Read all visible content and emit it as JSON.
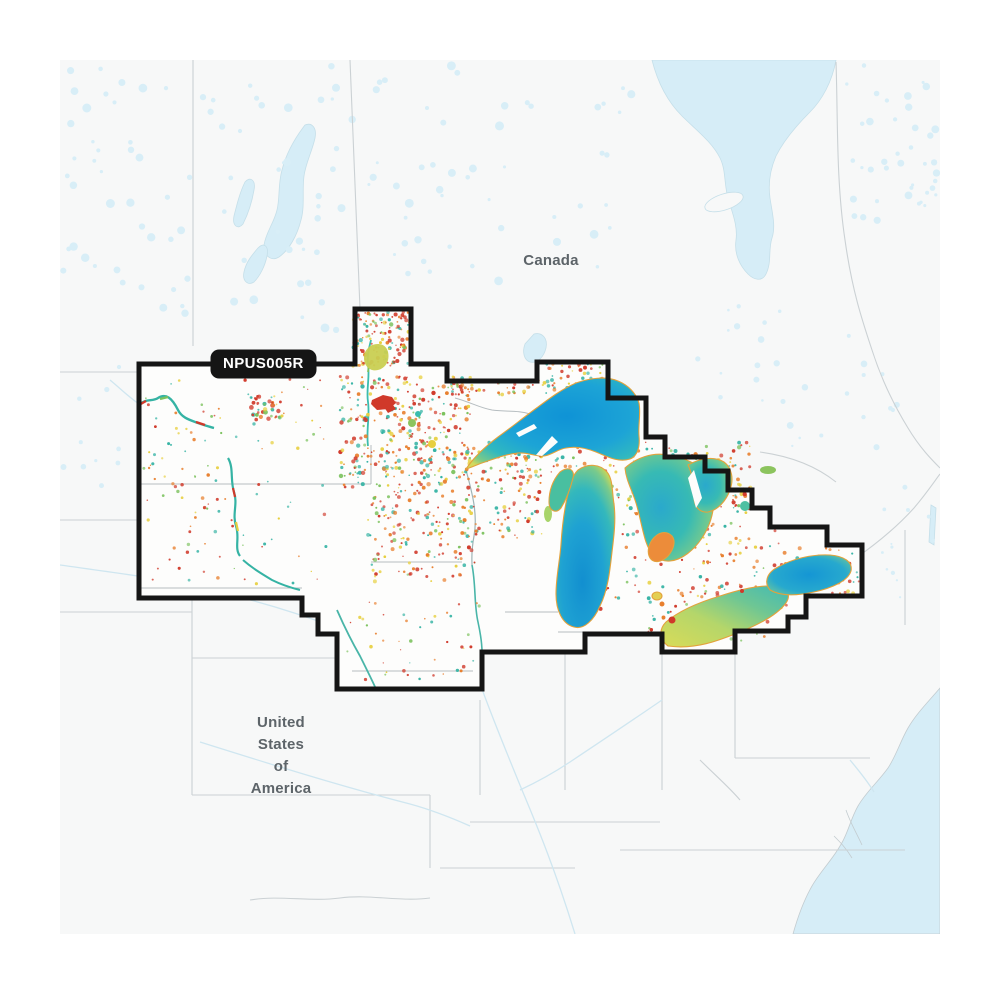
{
  "map": {
    "region_code": "NPUS005R",
    "labels": {
      "canada": "Canada",
      "us_lines": [
        "United",
        "States",
        "of",
        "America"
      ]
    },
    "colors": {
      "page_bg": "#ffffff",
      "land": "#f7f8f8",
      "water": "#d6edf7",
      "water_outline": "#c5dfe9",
      "coverage_fill": "#fdfdfc",
      "coverage_border": "#151515",
      "label_bg": "#151515",
      "label_text": "#ffffff",
      "country_label_text": "#5d6469",
      "admin_line": "#cbd1d4",
      "admin_line_inner": "#b6bdc0",
      "lake_deep_blue": "#128fd0",
      "lake_teal": "#34b8bc",
      "lake_green": "#7cca88",
      "lake_shallow_yellow": "#d3d95c",
      "shore_accent": "#e3a23c",
      "chart_red": "#d0392a",
      "chart_orange": "#e87f2e",
      "chart_yellow": "#e7cf3e",
      "chart_teal": "#35b3a4",
      "chart_green": "#7cc25e"
    },
    "speckle_palette": {
      "cov": [
        [
          "#d0392a",
          0.32
        ],
        [
          "#e87f2e",
          0.22
        ],
        [
          "#e7cf3e",
          0.16
        ],
        [
          "#35b3a4",
          0.19
        ],
        [
          "#7cc25e",
          0.11
        ]
      ],
      "pale": [
        [
          "#d8eef7",
          1.0
        ]
      ]
    },
    "speckle_clusters": [
      {
        "x": 62,
        "y": 62,
        "w": 300,
        "h": 268,
        "n": 80,
        "pal": "pale",
        "layer": "bg",
        "rmin": 1.5,
        "rmax": 4.5
      },
      {
        "x": 362,
        "y": 62,
        "w": 270,
        "h": 220,
        "n": 50,
        "pal": "pale",
        "layer": "bg",
        "rmin": 1.5,
        "rmax": 4.5
      },
      {
        "x": 845,
        "y": 62,
        "w": 92,
        "h": 160,
        "n": 40,
        "pal": "pale",
        "layer": "bg",
        "rmin": 1.5,
        "rmax": 4
      },
      {
        "x": 690,
        "y": 300,
        "w": 230,
        "h": 150,
        "n": 30,
        "pal": "pale",
        "layer": "bg",
        "rmin": 1.2,
        "rmax": 3.5
      },
      {
        "x": 62,
        "y": 340,
        "w": 72,
        "h": 160,
        "n": 10,
        "pal": "pale",
        "layer": "bg",
        "rmin": 1.2,
        "rmax": 3
      },
      {
        "x": 880,
        "y": 480,
        "w": 55,
        "h": 120,
        "n": 12,
        "pal": "pale",
        "layer": "bg",
        "rmin": 1,
        "rmax": 2.5
      },
      {
        "x": 353,
        "y": 312,
        "w": 56,
        "h": 54,
        "n": 130,
        "pal": "cov",
        "layer": "fg",
        "rmin": 0.7,
        "rmax": 2.2
      },
      {
        "x": 448,
        "y": 382,
        "w": 88,
        "h": 14,
        "n": 40,
        "pal": "cov",
        "layer": "fg",
        "rmin": 0.7,
        "rmax": 2
      },
      {
        "x": 538,
        "y": 364,
        "w": 68,
        "h": 30,
        "n": 55,
        "pal": "cov",
        "layer": "fg",
        "rmin": 0.7,
        "rmax": 2
      },
      {
        "x": 340,
        "y": 376,
        "w": 132,
        "h": 112,
        "n": 340,
        "pal": "cov",
        "layer": "fg",
        "rmin": 0.7,
        "rmax": 2.2
      },
      {
        "x": 368,
        "y": 490,
        "w": 108,
        "h": 92,
        "n": 150,
        "pal": "cov",
        "layer": "fg",
        "rmin": 0.7,
        "rmax": 2
      },
      {
        "x": 462,
        "y": 442,
        "w": 80,
        "h": 96,
        "n": 120,
        "pal": "cov",
        "layer": "fg",
        "rmin": 0.7,
        "rmax": 2
      },
      {
        "x": 500,
        "y": 440,
        "w": 115,
        "h": 36,
        "n": 70,
        "pal": "cov",
        "layer": "fg",
        "rmin": 0.7,
        "rmax": 2
      },
      {
        "x": 142,
        "y": 374,
        "w": 188,
        "h": 210,
        "n": 120,
        "pal": "cov",
        "layer": "fg",
        "rmin": 0.6,
        "rmax": 1.8
      },
      {
        "x": 250,
        "y": 396,
        "w": 34,
        "h": 24,
        "n": 40,
        "pal": "cov",
        "layer": "fg",
        "rmin": 0.8,
        "rmax": 2.4
      },
      {
        "x": 565,
        "y": 472,
        "w": 100,
        "h": 148,
        "n": 95,
        "pal": "cov",
        "layer": "fg",
        "rmin": 0.7,
        "rmax": 2
      },
      {
        "x": 628,
        "y": 442,
        "w": 125,
        "h": 72,
        "n": 160,
        "pal": "cov",
        "layer": "fg",
        "rmin": 0.7,
        "rmax": 2.2
      },
      {
        "x": 675,
        "y": 522,
        "w": 115,
        "h": 88,
        "n": 95,
        "pal": "cov",
        "layer": "fg",
        "rmin": 0.7,
        "rmax": 2
      },
      {
        "x": 792,
        "y": 548,
        "w": 68,
        "h": 46,
        "n": 50,
        "pal": "cov",
        "layer": "fg",
        "rmin": 0.7,
        "rmax": 2
      },
      {
        "x": 345,
        "y": 600,
        "w": 135,
        "h": 80,
        "n": 45,
        "pal": "cov",
        "layer": "fg",
        "rmin": 0.6,
        "rmax": 1.8
      },
      {
        "x": 648,
        "y": 588,
        "w": 130,
        "h": 56,
        "n": 55,
        "pal": "cov",
        "layer": "fg",
        "rmin": 0.7,
        "rmax": 2
      }
    ]
  }
}
